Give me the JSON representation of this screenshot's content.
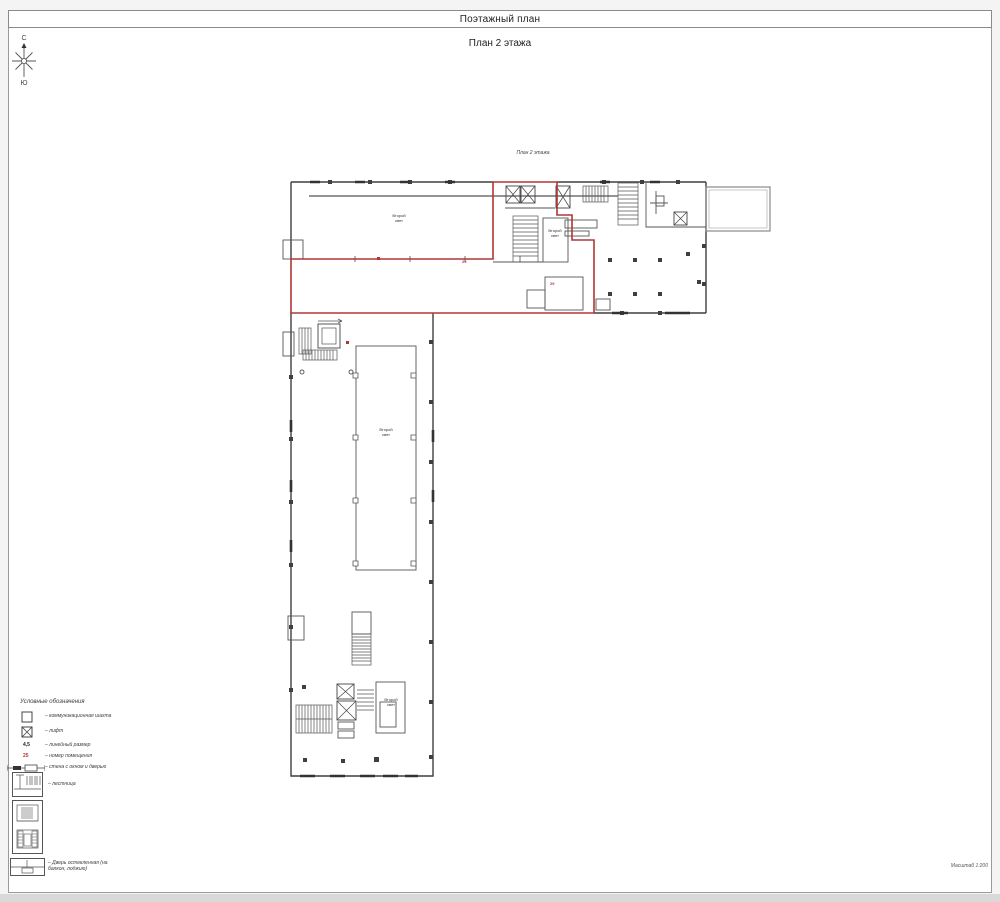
{
  "page": {
    "title": "Поэтажный план",
    "subtitle": "План 2 этажа",
    "scale_label": "Масштаб 1:200"
  },
  "compass": {
    "north": "С",
    "south": "Ю"
  },
  "plan": {
    "caption": "План 2 этажа",
    "labels": {
      "upper_hall": "Второй свет",
      "stair_room": "Второй свет",
      "atrium": "Второй свет",
      "lower_room": "Второй свет"
    },
    "room_numbers": {
      "num_1": "29",
      "num_2": "29"
    },
    "colors": {
      "wall": "#3f3f3f",
      "highlight": "#b03636"
    }
  },
  "legend": {
    "title": "Условные обозначения",
    "items": [
      {
        "name": "communication-shaft",
        "label": "– коммуникационная шахта"
      },
      {
        "name": "elevator",
        "label": "– лифт"
      },
      {
        "name": "linear-dimension",
        "sample": "4,5",
        "label": "– линейный размер"
      },
      {
        "name": "room-number",
        "sample": "25",
        "label": "– номер помещения"
      },
      {
        "name": "wall-window-door",
        "label": "– стена с окном и дверью"
      },
      {
        "name": "stairs",
        "label": "– лестница"
      },
      {
        "name": "stairs-section",
        "label": ""
      },
      {
        "name": "glazed-door",
        "label": "– Дверь остекленная (на балкон, лоджию)"
      }
    ]
  }
}
